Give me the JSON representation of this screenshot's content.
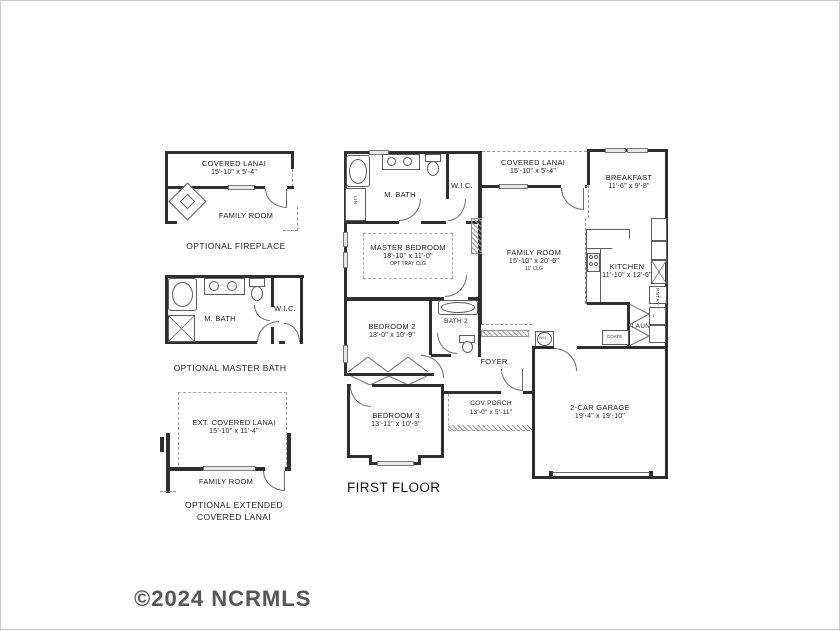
{
  "watermark": "©2024 NCRMLS",
  "main": {
    "title": "FIRST FLOOR",
    "covered_lanai": {
      "name": "COVERED LANAI",
      "dims": "15'-10\" x 5'-4\""
    },
    "m_bath": {
      "name": "M. BATH"
    },
    "lin": {
      "name": "LIN"
    },
    "wic": {
      "name": "W.I.C."
    },
    "master_bedroom": {
      "name": "MASTER BEDROOM",
      "dims": "18'-10\" x 11'-0\"",
      "note": "OPT TRAY CLG"
    },
    "family_room": {
      "name": "FAMILY ROOM",
      "dims": "15'-10\" x 20'-6\"",
      "note": "11' CLG"
    },
    "breakfast": {
      "name": "BREAKFAST",
      "dims": "11'-6\" x 9'-8\""
    },
    "kitchen": {
      "name": "KITCHEN",
      "dims": "11'-10\" x 12'-6\""
    },
    "pantry": {
      "name": "PNTRY"
    },
    "laundry": {
      "name": "LAUN."
    },
    "coats": {
      "name": "COATS"
    },
    "water_heater": {
      "name": "W.H."
    },
    "bedroom2": {
      "name": "BEDROOM 2",
      "dims": "13'-0\" x 10'-9\""
    },
    "bath2": {
      "name": "BATH 2"
    },
    "foyer": {
      "name": "FOYER"
    },
    "bedroom3": {
      "name": "BEDROOM 3",
      "dims": "13'-11\" x 10'-3\""
    },
    "cov_porch": {
      "name": "COV PORCH",
      "dims": "13'-0\" x 5'-11\""
    },
    "garage": {
      "name": "2-CAR GARAGE",
      "dims": "19'-4\" x 19'-10\""
    }
  },
  "option_fireplace": {
    "caption": "OPTIONAL FIREPLACE",
    "covered_lanai": {
      "name": "COVERED LANAI",
      "dims": "15'-10\" x 5'-4\""
    },
    "family_room": {
      "name": "FAMILY ROOM"
    }
  },
  "option_master_bath": {
    "caption": "OPTIONAL MASTER BATH",
    "m_bath": {
      "name": "M. BATH"
    },
    "wic": {
      "name": "W.I.C."
    }
  },
  "option_ext_lanai": {
    "caption_line1": "OPTIONAL EXTENDED",
    "caption_line2": "COVERED LANAI",
    "ext_lanai": {
      "name": "EXT. COVERED LANAI",
      "dims": "15'-10\" x 11'-4\""
    },
    "family_room": {
      "name": "FAMILY ROOM"
    }
  }
}
